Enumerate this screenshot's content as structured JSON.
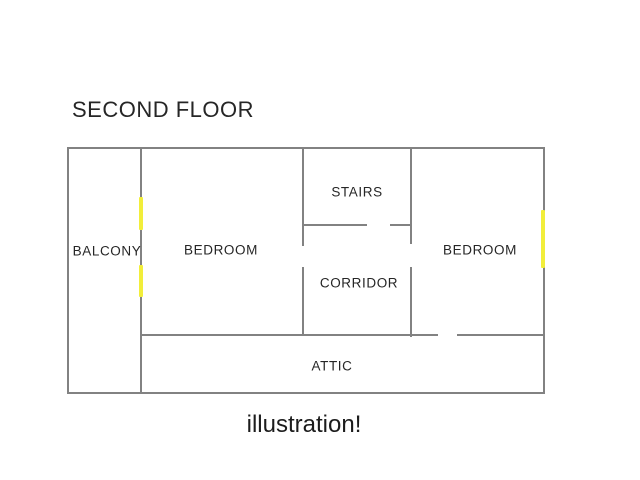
{
  "title": "SECOND FLOOR",
  "caption": "illustration!",
  "colors": {
    "wall": "#828282",
    "door_marker": "#f2ee3a",
    "text": "#262626",
    "background": "#ffffff"
  },
  "floorplan": {
    "rooms": [
      {
        "label": "BALCONY",
        "cx": 107,
        "cy": 251
      },
      {
        "label": "BEDROOM",
        "cx": 221,
        "cy": 250
      },
      {
        "label": "STAIRS",
        "cx": 357,
        "cy": 192
      },
      {
        "label": "CORRIDOR",
        "cx": 359,
        "cy": 283
      },
      {
        "label": "BEDROOM",
        "cx": 480,
        "cy": 250
      },
      {
        "label": "ATTIC",
        "cx": 332,
        "cy": 366
      }
    ],
    "walls": [
      {
        "name": "outer-wall-top",
        "x": 67,
        "y": 147,
        "w": 478,
        "h": 2
      },
      {
        "name": "outer-wall-bottom",
        "x": 67,
        "y": 392,
        "w": 478,
        "h": 2
      },
      {
        "name": "outer-wall-left",
        "x": 67,
        "y": 147,
        "w": 2,
        "h": 247
      },
      {
        "name": "outer-wall-right",
        "x": 543,
        "y": 147,
        "w": 2,
        "h": 247
      },
      {
        "name": "balcony-bedroom-wall",
        "x": 140,
        "y": 147,
        "w": 2,
        "h": 247
      },
      {
        "name": "bedroom1-stairs-wall-upper",
        "x": 302,
        "y": 147,
        "w": 2,
        "h": 99
      },
      {
        "name": "bedroom1-corridor-wall-lower",
        "x": 302,
        "y": 267,
        "w": 2,
        "h": 69
      },
      {
        "name": "stairs-bedroom2-wall-upper",
        "x": 410,
        "y": 147,
        "w": 2,
        "h": 97
      },
      {
        "name": "corridor-bedroom2-wall-lower",
        "x": 410,
        "y": 267,
        "w": 2,
        "h": 70
      },
      {
        "name": "stairs-bottom-wall-left",
        "x": 302,
        "y": 224,
        "w": 65,
        "h": 2
      },
      {
        "name": "stairs-bottom-wall-right",
        "x": 390,
        "y": 224,
        "w": 22,
        "h": 2
      },
      {
        "name": "attic-top-wall-left",
        "x": 140,
        "y": 334,
        "w": 298,
        "h": 2
      },
      {
        "name": "attic-top-wall-right",
        "x": 457,
        "y": 334,
        "w": 88,
        "h": 2
      }
    ],
    "door_markers": [
      {
        "name": "balcony-door-marker-upper",
        "x": 139,
        "y": 197,
        "w": 4,
        "h": 33
      },
      {
        "name": "balcony-door-marker-lower",
        "x": 139,
        "y": 265,
        "w": 4,
        "h": 32
      },
      {
        "name": "bedroom2-door-marker",
        "x": 541,
        "y": 210,
        "w": 4,
        "h": 58
      }
    ]
  }
}
